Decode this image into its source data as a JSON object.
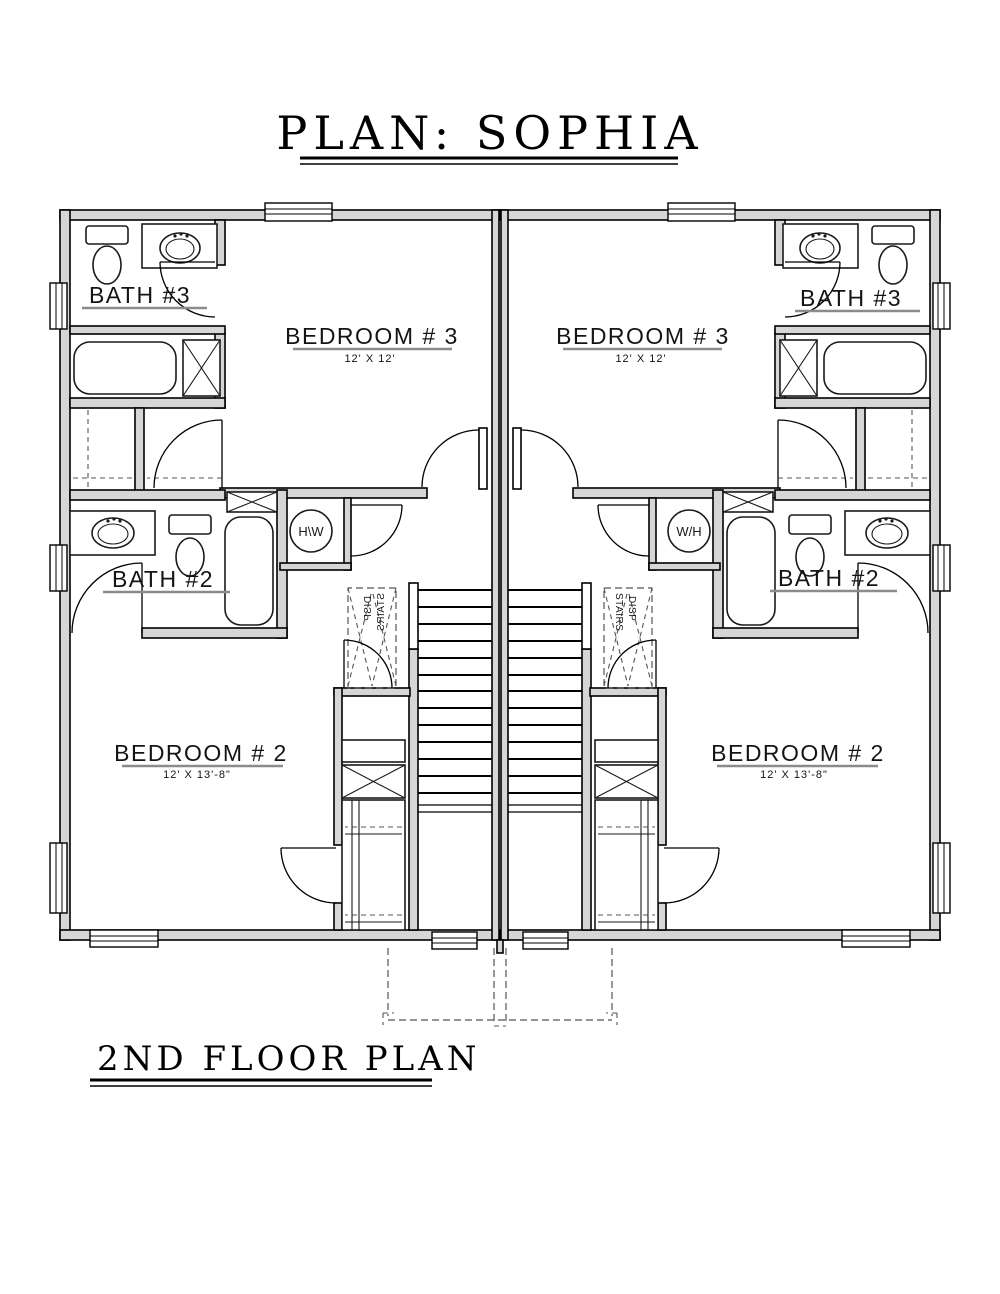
{
  "title": "PLAN: SOPHIA",
  "floor_label": "2ND FLOOR PLAN",
  "colors": {
    "wall_fill": "#d6d6d6",
    "line": "#000000",
    "underline": "#8b8b8b"
  },
  "rooms": {
    "bath3": {
      "label": "BATH #3"
    },
    "bedroom3": {
      "label": "BEDROOM # 3",
      "dims": "12' X 12'"
    },
    "bath2": {
      "label": "BATH #2"
    },
    "bedroom2": {
      "label": "BEDROOM # 2",
      "dims": "12' X 13'-8\""
    }
  },
  "fixtures": {
    "water_heater": "W/H",
    "stairs": "STAIRS",
    "disappearing": "DISP"
  }
}
